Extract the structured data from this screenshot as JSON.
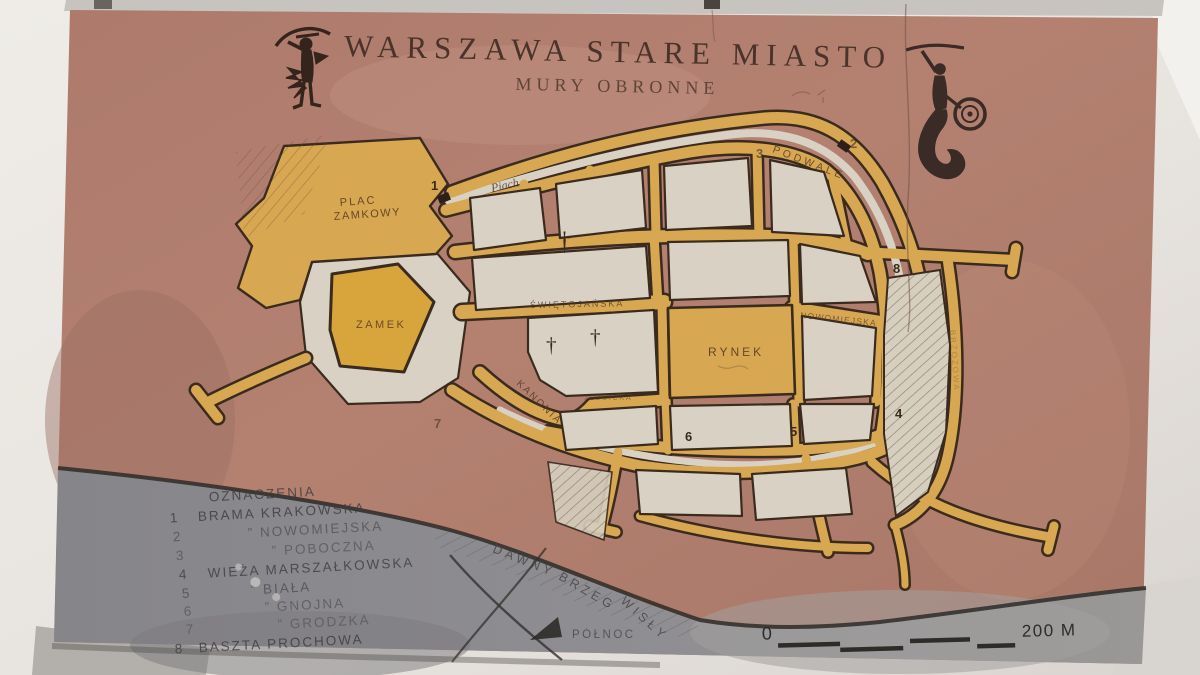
{
  "title": {
    "main": "WARSZAWA STARE MIASTO",
    "subtitle": "MURY OBRONNE"
  },
  "map_labels": {
    "plac_zamkowy_1": "PLAC",
    "plac_zamkowy_2": "ZAMKOWY",
    "zamek": "ZAMEK",
    "rynek": "RYNEK",
    "swietojanska": "ŚWIĘTOJAŃSKA",
    "nowomiejska": "NOWOMIEJSKA",
    "podwale": "PODWALE",
    "kanonia": "KANONIA",
    "jezuicka": "JEZUICKA",
    "brzozowa": "BRZOZOWA",
    "piach": "Piach"
  },
  "river_label": {
    "word1": "DAWNY",
    "word2": "BRZEG",
    "word3": "WISŁY"
  },
  "markers": [
    "1",
    "2",
    "3",
    "4",
    "5",
    "6",
    "7",
    "8"
  ],
  "symbols": {
    "church_cross": "†"
  },
  "legend": {
    "heading": "OZNACZENIA",
    "items": [
      {
        "num": "1",
        "label": "BRAMA KRAKOWSKA"
      },
      {
        "num": "2",
        "label": "”  NOWOMIEJSKA"
      },
      {
        "num": "3",
        "label": "”  POBOCZNA"
      },
      {
        "num": "4",
        "label": "WIEŻA MARSZAŁKOWSKA"
      },
      {
        "num": "5",
        "label": "”  BIAŁA"
      },
      {
        "num": "6",
        "label": "”  GNOJNA"
      },
      {
        "num": "7",
        "label": "”  GRODZKA"
      },
      {
        "num": "8",
        "label": "BASZTA PROCHOWA"
      }
    ]
  },
  "compass": {
    "north": "PÓŁNOC"
  },
  "scale_bar": {
    "start": "0",
    "end": "200 M"
  },
  "colors": {
    "plaque_terracotta": "#b07c6d",
    "streets_ochre": "#d7a751",
    "blocks_cream": "#d9d2c4",
    "river_gray": "#8d8c90",
    "outline_dark": "#3b2b1e",
    "carved_text": "#4a332a"
  }
}
